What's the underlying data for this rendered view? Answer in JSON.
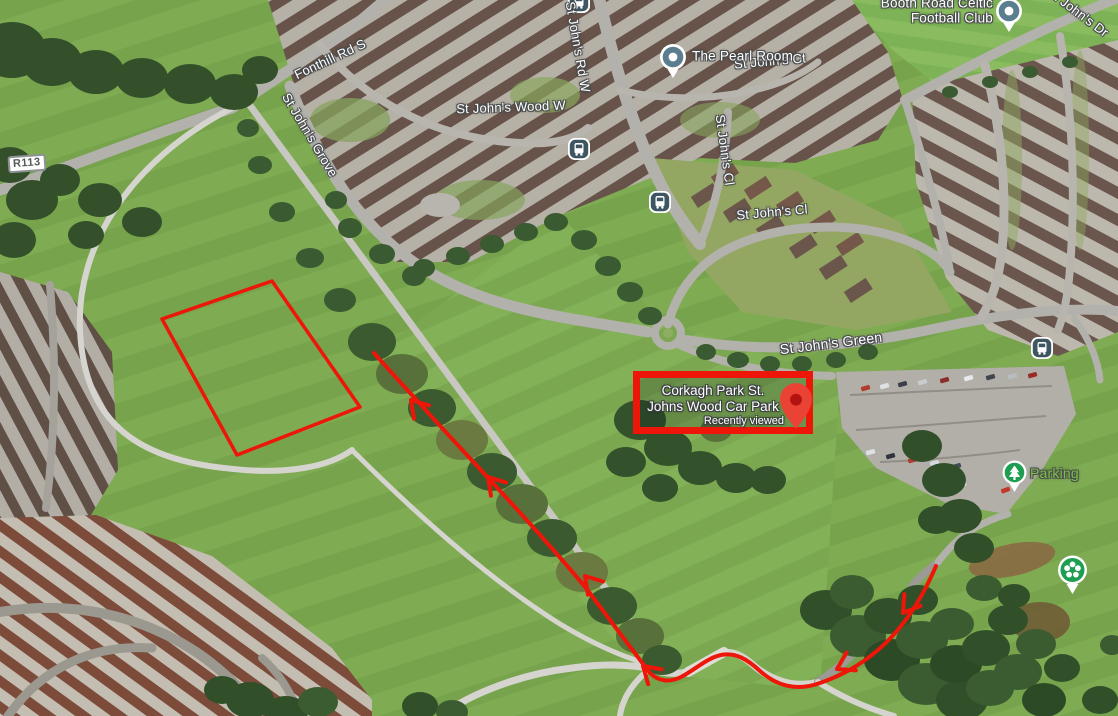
{
  "map": {
    "road_shield": {
      "label": "R113"
    },
    "street_labels": {
      "fonthill": "Fonthill Rd S",
      "grove": "St John's Grove",
      "wood_w": "St John's Wood W",
      "rd_w": "St John's Rd W",
      "ct": "St John's Ct",
      "cl_upper": "St John's Cl",
      "cl_lower": "St John's Cl",
      "green": "St John's Green",
      "dr": "St John's Dr"
    },
    "pois": {
      "pearl_room": "The Pearl Room",
      "football_club_line1": "Booth Road Celtic",
      "football_club_line2": "Football Club",
      "parking": "Parking"
    },
    "destination": {
      "name_line1": "Corkagh Park St.",
      "name_line2": "Johns Wood Car Park",
      "status": "Recently viewed"
    },
    "icons": {
      "poi_pin": "circle-pin",
      "bus_stop": "bus-icon",
      "parking_pin": "tree-pin",
      "garden_pin": "flower-pin",
      "destination_pin": "red-map-pin"
    },
    "colors": {
      "annotation_red": "#ee1509",
      "pin_red": "#EA4335",
      "pin_red_dark": "#B31412",
      "poi_teal": "#5b7e8f",
      "transit_slate": "#3e5661",
      "park_pin_green": "#1e9e50",
      "park_label_green": "#79c143"
    }
  }
}
